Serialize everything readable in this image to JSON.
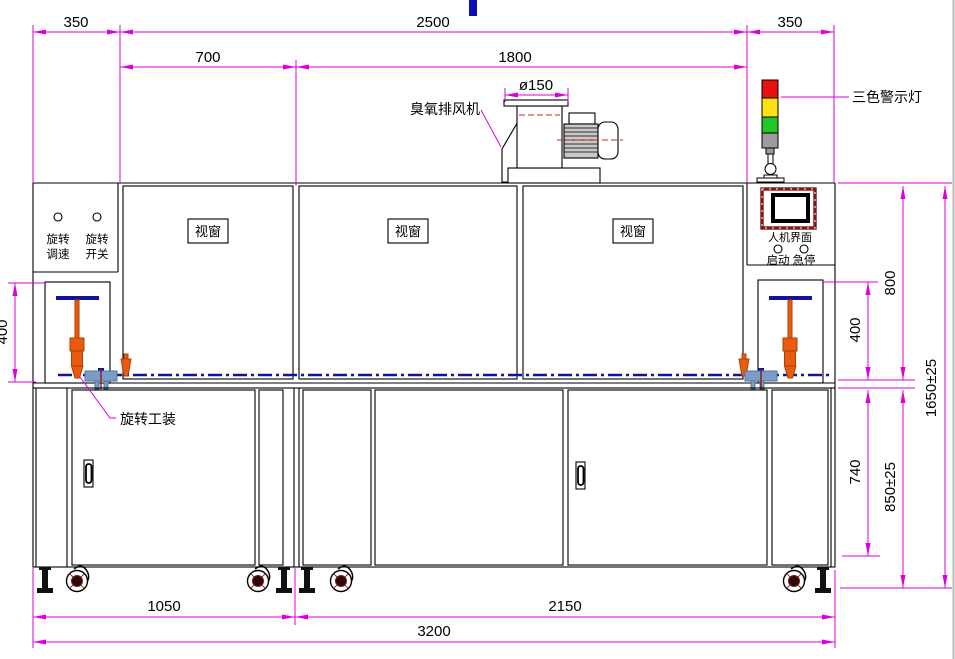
{
  "drawing": {
    "title_hint": "机械设备正视图 (machine front-view engineering drawing)",
    "dims": {
      "top_left_350": "350",
      "top_2500": "2500",
      "top_right_350": "350",
      "d700": "700",
      "d1800": "1800",
      "dia150": "ø150",
      "left_400": "400",
      "right_400": "400",
      "d800": "800",
      "d740": "740",
      "d850": "850±25",
      "d1650": "1650±25",
      "d1050": "1050",
      "d2150": "2150",
      "d3200": "3200"
    },
    "labels": {
      "ozone_fan": "臭氧排风机",
      "tricolor_light": "三色警示灯",
      "viewport_1": "视窗",
      "viewport_2": "视窗",
      "viewport_3": "视窗",
      "hmi": "人机界面",
      "start_btn": "启动",
      "estop_btn": "急停",
      "rot_speed_l1": "旋转",
      "rot_speed_l2": "调速",
      "rot_switch_l1": "旋转",
      "rot_switch_l2": "开关",
      "rotate_fixture": "旋转工装"
    },
    "colors": {
      "dimension": "#dd00dd",
      "outline": "#000000",
      "centerline_navy": "#12129a",
      "fixture_orange": "#eb5a0f",
      "bracket_blue": "#7b9cc4",
      "hmi_frame_darkred": "#7d1717",
      "light_red": "#e81111",
      "light_yellow": "#ffe013",
      "light_green": "#26c526",
      "light_gray": "#9c9c9c",
      "motor_gray": "#c8c8c8"
    }
  }
}
